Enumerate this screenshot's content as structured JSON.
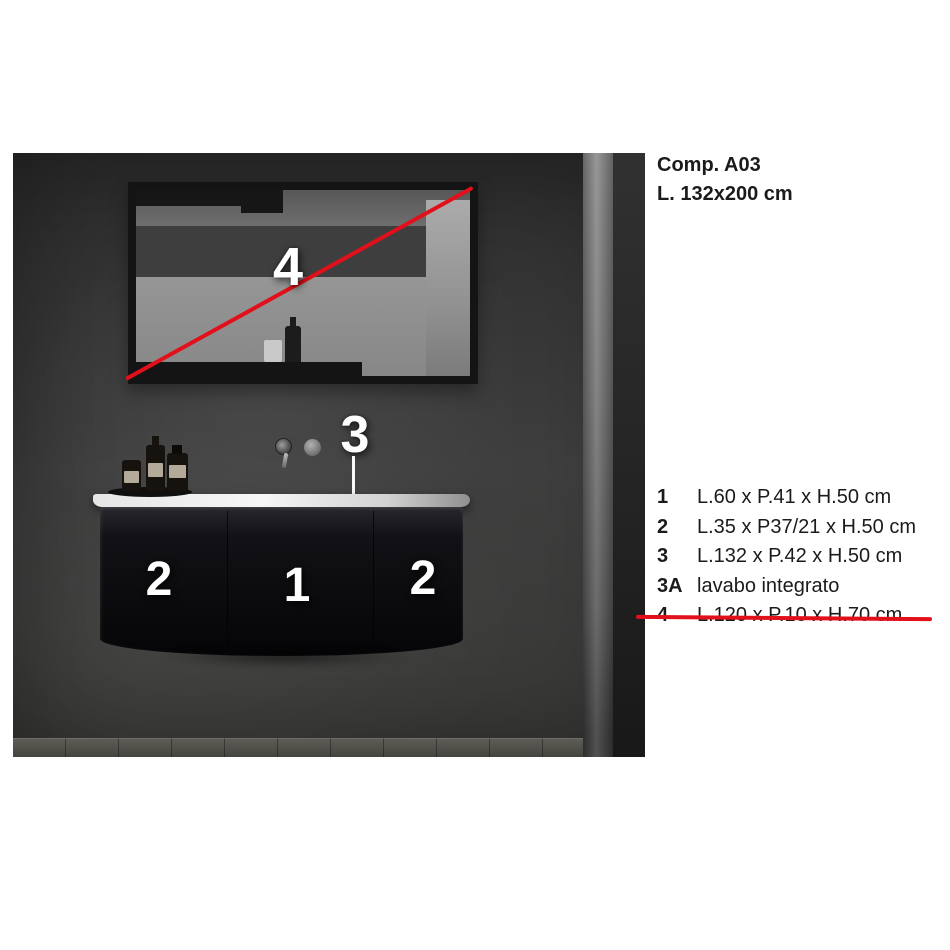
{
  "header": {
    "title": "Comp. A03",
    "subtitle": "L. 132x200 cm"
  },
  "legend": {
    "items": [
      {
        "num": "1",
        "text": "L.60 x P.41 x H.50 cm"
      },
      {
        "num": "2",
        "text": "L.35 x P37/21 x H.50 cm"
      },
      {
        "num": "3",
        "text": "L.132 x P.42 x H.50 cm"
      },
      {
        "num": "3A",
        "text": "lavabo integrato"
      },
      {
        "num": "4",
        "text": "L.120 x P.10 x H.70 cm",
        "struck": true
      }
    ]
  },
  "photo": {
    "callouts": {
      "mirror_label": "4",
      "basin_label": "3",
      "door_left_label": "2",
      "door_center_label": "1",
      "door_right_label": "2"
    },
    "colors": {
      "accent_red": "#e2101a",
      "wall": "#3a3a3a",
      "cabinet": "#0c0c0f",
      "countertop": "#eeeeee",
      "mirror_frame": "#141414",
      "floor": "#53524c",
      "text": "#1b1b1b"
    }
  }
}
